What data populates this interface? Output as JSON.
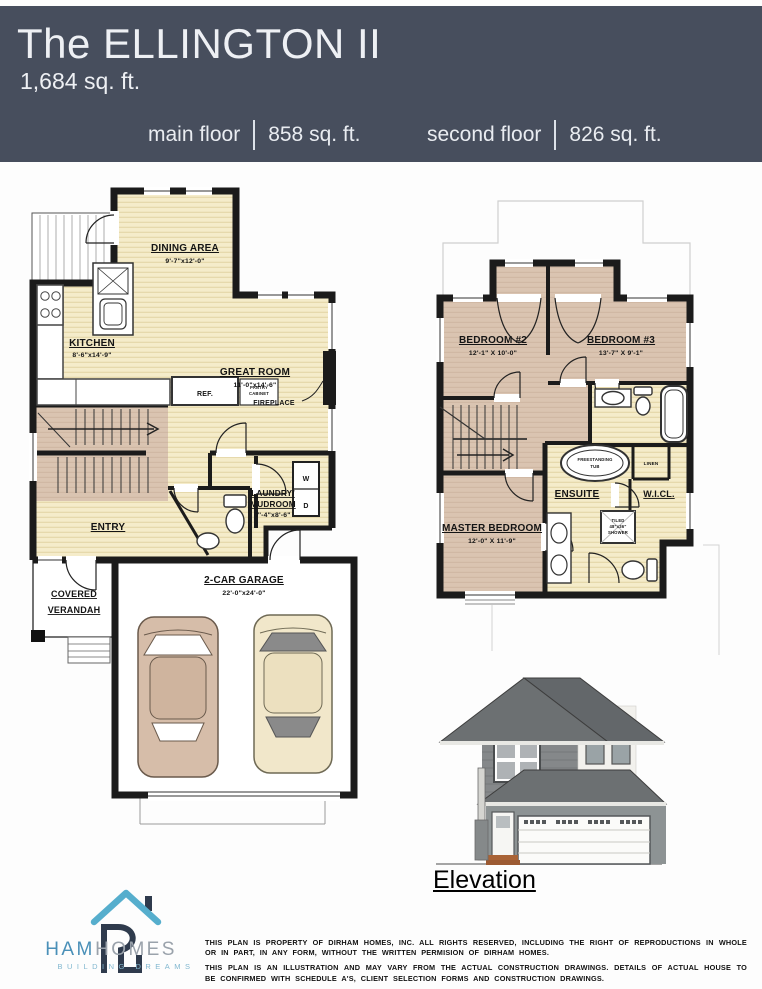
{
  "header": {
    "title": "The ELLINGTON II",
    "subtitle": "1,684 sq. ft.",
    "floors": [
      {
        "label": "main floor",
        "area": "858 sq. ft."
      },
      {
        "label": "second floor",
        "area": "826 sq. ft."
      }
    ]
  },
  "main_floor": {
    "dining": {
      "name": "DINING AREA",
      "dims": "9'-7\"x12'-0\""
    },
    "kitchen": {
      "name": "KITCHEN",
      "dims": "8'-6\"x14'-9\""
    },
    "great_room": {
      "name": "GREAT ROOM",
      "dims": "11'-0\"x14'-6\""
    },
    "fireplace": "FIREPLACE",
    "fridge": "REF.",
    "pantry_line1": "PANTRY",
    "pantry_line2": "CABINET",
    "entry": "ENTRY",
    "laundry_line1": "LAUNDRY/",
    "laundry_line2": "MUDROOM",
    "laundry_dims": "7'-4\"x8'-6\"",
    "washer": "W",
    "dryer": "D",
    "verandah_line1": "COVERED",
    "verandah_line2": "VERANDAH",
    "garage": {
      "name": "2-CAR GARAGE",
      "dims": "22'-0\"x24'-0\""
    }
  },
  "second_floor": {
    "bedroom2": {
      "name": "BEDROOM #2",
      "dims": "12'-1\" X 10'-0\""
    },
    "bedroom3": {
      "name": "BEDROOM #3",
      "dims": "13'-7\" X 9'-1\""
    },
    "master": {
      "name": "MASTER BEDROOM",
      "dims": "12'-0\" X 11'-9\""
    },
    "ensuite": "ENSUITE",
    "wicl": "W.I.CL.",
    "linen": "LINEN",
    "tub_line1": "FREESTANDING",
    "tub_line2": "TUB",
    "shower_line1": "TILED",
    "shower_line2": "48\"x36\"",
    "shower_line3": "SHOWER"
  },
  "elevation": {
    "label": "Elevation"
  },
  "logo": {
    "brand_primary": "DIRHAM",
    "brand_secondary": "HOMES",
    "tagline": "BUILDING DREAMS"
  },
  "legal": {
    "p1": "THIS PLAN IS PROPERTY OF DIRHAM HOMES, INC. ALL RIGHTS RESERVED, INCLUDING THE RIGHT OF REPRODUCTIONS IN WHOLE OR IN PART, IN ANY FORM, WITHOUT THE WRITTEN PERMISION OF DIRHAM HOMES.",
    "p2": "THIS PLAN IS AN ILLUSTRATION AND MAY VARY FROM THE ACTUAL CONSTRUCTION DRAWINGS. DETAILS OF ACTUAL HOUSE TO BE CONFIRMED WITH SCHEDULE A'S, CLIENT SELECTION FORMS AND CONSTRUCTION DRAWINGS."
  },
  "colors": {
    "header_bg": "#474e5d",
    "wall": "#1b1b1b",
    "floor_cream": "#f5ecca",
    "floor_cream_stripe": "#e3d6a7",
    "floor_tan": "#dac4b1",
    "logo_roof_blue": "#56aecd",
    "logo_navy": "#2f3b4d",
    "brand_blue": "#4a90b8",
    "brand_gray": "#9aa2ab",
    "tagline_blue": "#82b8d0"
  }
}
